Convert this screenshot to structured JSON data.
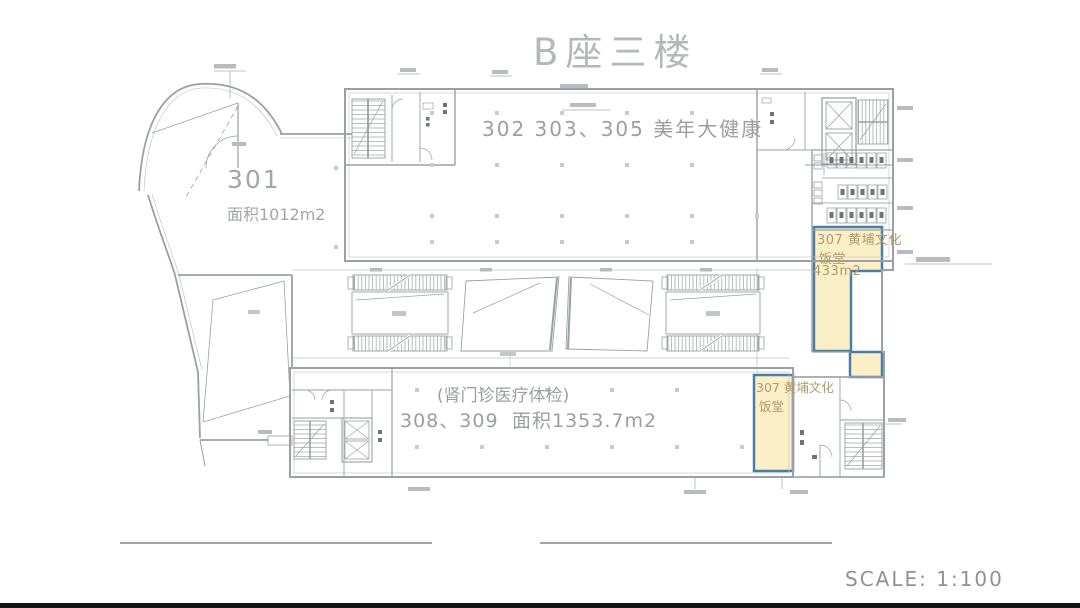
{
  "title": "B座三楼",
  "scale": {
    "label": "SCALE: 1:100"
  },
  "units": {
    "u301": {
      "number": "301",
      "area": "面积1012m2"
    },
    "u302": {
      "rooms_and_name": "302  303、305  美年大健康"
    },
    "u308": {
      "note": "(肾门诊医疗体检)",
      "rooms": "308、309",
      "area": "面积1353.7m2"
    },
    "u307_north": {
      "title": "307 黄埔文化",
      "type": "饭堂",
      "area": "433m2",
      "fill": "#faefc6",
      "border": "#4a7da8"
    },
    "u307_south": {
      "title": "307 黄埔文化",
      "type": "饭堂",
      "fill": "#faefc6",
      "border": "#4a7da8"
    }
  },
  "drawing": {
    "wall_color": "#9aa0a4",
    "detail_color": "#aeb2b5",
    "text_gray": "#9b9ea0",
    "highlight_text_color": "#b39a6c"
  }
}
